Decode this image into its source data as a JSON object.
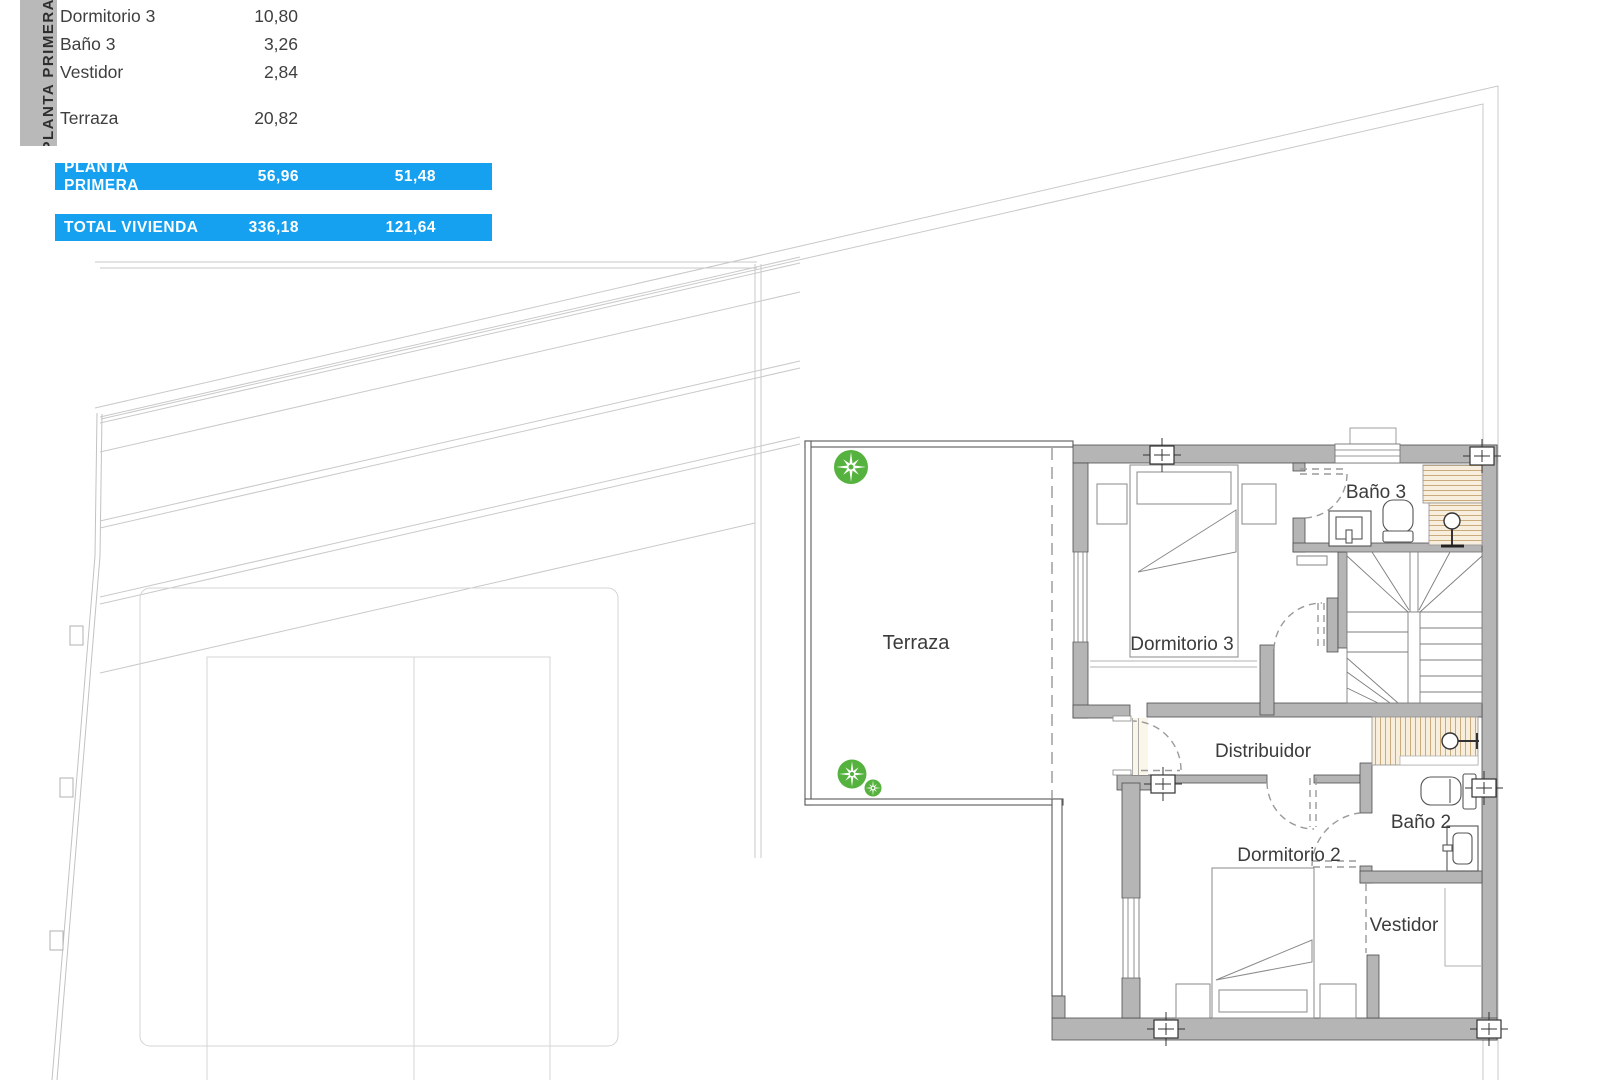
{
  "sidebar": {
    "label": "PLANTA PRIMERA"
  },
  "legend": {
    "rows": [
      {
        "name": "Dormitorio 3",
        "area": "10,80"
      },
      {
        "name": "Baño 3",
        "area": "3,26"
      },
      {
        "name": "Vestidor",
        "area": "2,84"
      },
      {
        "name": "Terraza",
        "area": "20,82"
      }
    ]
  },
  "totals": {
    "rows": [
      {
        "label": "PLANTA PRIMERA",
        "col1": "56,96",
        "col2": "51,48"
      },
      {
        "label": "TOTAL VIVIENDA",
        "col1": "336,18",
        "col2": "121,64"
      }
    ]
  },
  "plan": {
    "rooms": [
      {
        "label": "Terraza"
      },
      {
        "label": "Dormitorio 3"
      },
      {
        "label": "Baño 3"
      },
      {
        "label": "Distribuidor"
      },
      {
        "label": "Dormitorio 2"
      },
      {
        "label": "Baño 2"
      },
      {
        "label": "Vestidor"
      }
    ]
  },
  "colors": {
    "accent_blue": "#16a0f0",
    "bar_gray": "#b9b9b9",
    "wall_gray": "#b5b5b5",
    "shower_beige": "#f8eedd",
    "plant_green": "#56b23e"
  }
}
